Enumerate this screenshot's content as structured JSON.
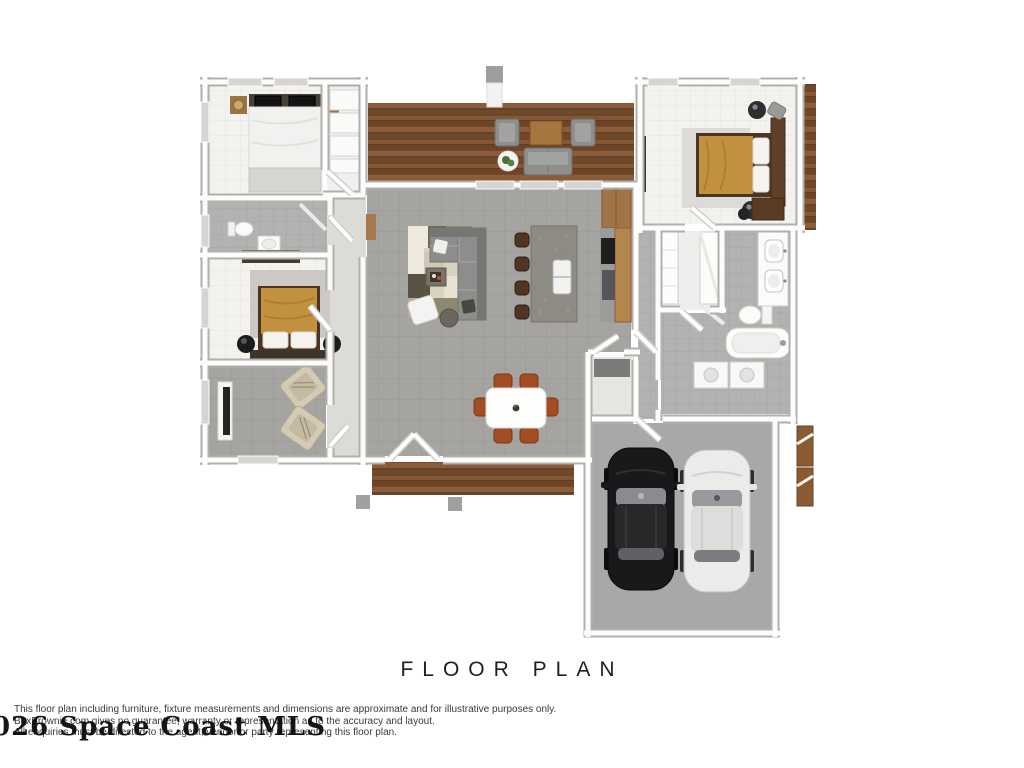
{
  "title": "FLOOR PLAN",
  "watermark": "026 Space Coast MLS",
  "disclaimer": {
    "line1": "This floor plan including furniture, fixture measurements and dimensions are approximate and for illustrative purposes only.",
    "line2": "BoxBrownie.com gives no guarantee, warranty or representation as to the accuracy and layout.",
    "line3": "All enquiries must be directed to the agent, vendor or party representing this floor plan."
  },
  "palette": {
    "wall_gray": "#b1b0ae",
    "wall_white": "#fcfcfb",
    "floor_tile_gray": "#a5a4a1",
    "floor_tile_light": "#f3f2ef",
    "bath_tile_gray": "#b3b2b0",
    "deck_wood_brown": "#7b5133",
    "bedding_gold": "#c2913f",
    "bedding_white": "#f2f1ef",
    "sofa_gray": "#8d8d8b",
    "dining_chair_rust": "#a34d22",
    "car_black": "#19191b",
    "car_white": "#ebebe9",
    "text_dark": "#1f1f1f"
  }
}
